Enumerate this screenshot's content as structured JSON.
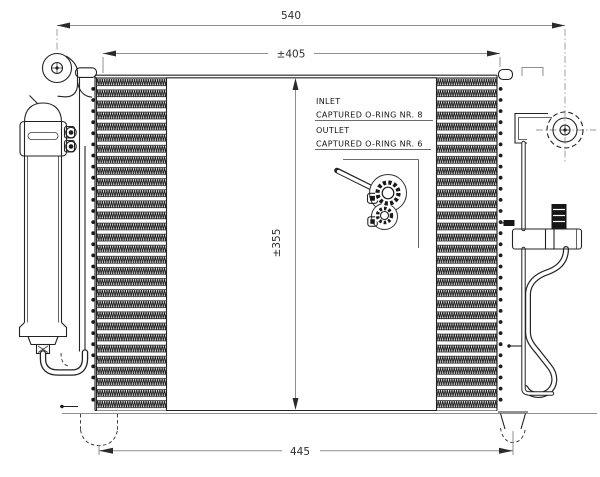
{
  "drawing": {
    "dimensions": {
      "overall_width": "540",
      "tube_width": "±405",
      "core_height": "±355",
      "mount_spacing": "445"
    },
    "annotations": {
      "inlet_label": "INLET",
      "inlet_note": "CAPTURED O-RING NR. 8",
      "outlet_label": "OUTLET",
      "outlet_note": "CAPTURED O-RING NR. 6"
    },
    "colors": {
      "line": "#232323",
      "dimension_line": "#8f8f8f",
      "text": "#141414",
      "background": "#ffffff"
    }
  }
}
